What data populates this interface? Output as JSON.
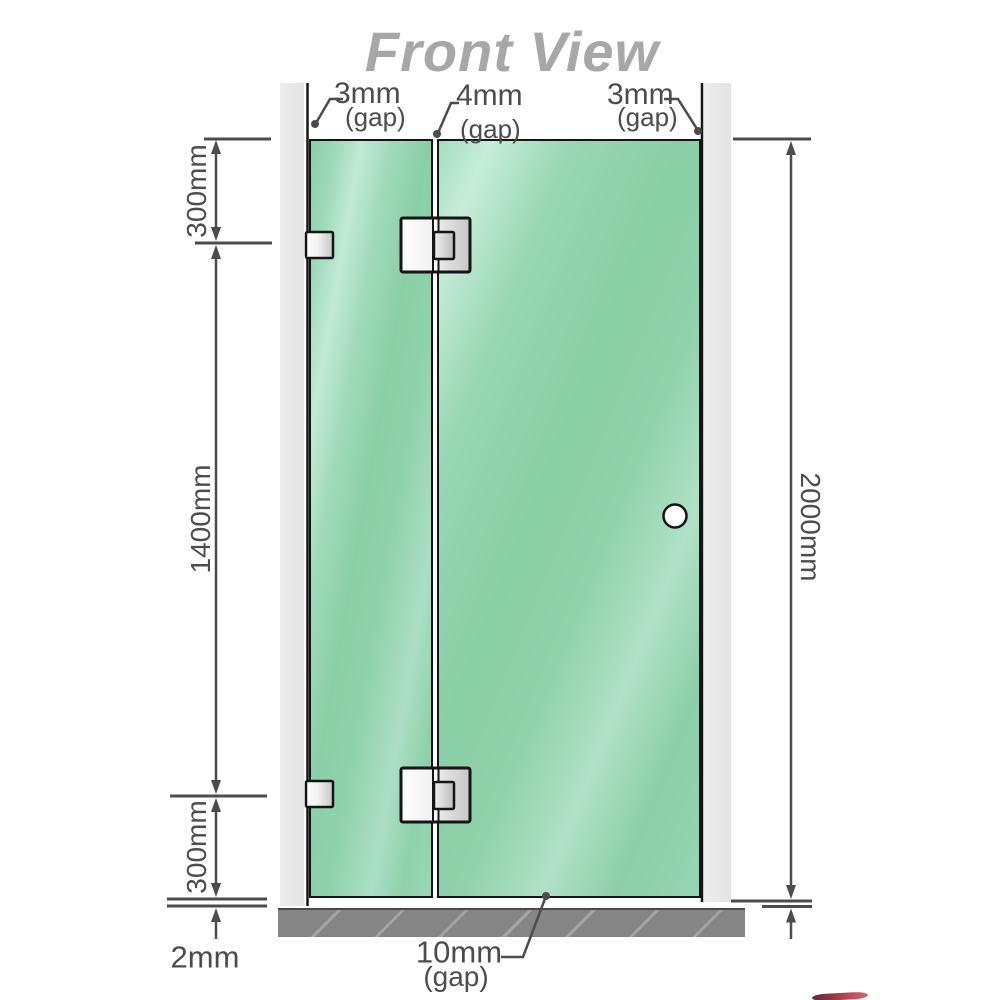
{
  "title": "Front View",
  "diagram": {
    "top_gaps": [
      {
        "label": "3mm",
        "sub": "(gap)"
      },
      {
        "label": "4mm",
        "sub": "(gap)"
      },
      {
        "label": "3mm",
        "sub": "(gap)"
      }
    ],
    "left_dims": {
      "top": "300mm",
      "middle": "1400mm",
      "bottom": "300mm",
      "floor_offset": "2mm"
    },
    "right_dims": {
      "total_height": "2000mm"
    },
    "bottom_gap": {
      "label": "10mm",
      "sub": "(gap)"
    }
  },
  "colors": {
    "glass_green": "#8fd2ae",
    "wall_gray": "#e8e8e8",
    "floor_gray": "#858585",
    "dimension_gray": "#4c4c4c",
    "title_gray": "#a7a7a7",
    "hardware_outline": "#151515"
  }
}
